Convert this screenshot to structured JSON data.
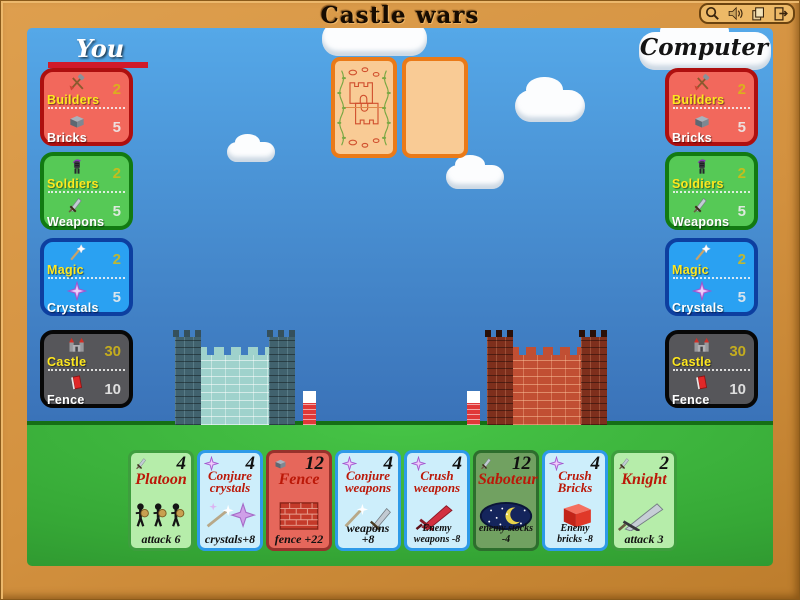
{
  "title": "Castle wars",
  "toolbar": {
    "icons": [
      "magnifier-icon",
      "sound-icon",
      "cards-icon",
      "exit-icon"
    ]
  },
  "players": {
    "you": "You",
    "computer": "Computer"
  },
  "stats": {
    "left": [
      {
        "rows": [
          {
            "icon": "tools-icon",
            "label": "Builders",
            "value": "2"
          },
          {
            "icon": "brick-icon",
            "label": "Bricks",
            "value": "5"
          }
        ]
      },
      {
        "rows": [
          {
            "icon": "soldier-icon",
            "label": "Soldiers",
            "value": "2"
          },
          {
            "icon": "sword-icon",
            "label": "Weapons",
            "value": "5"
          }
        ]
      },
      {
        "rows": [
          {
            "icon": "wand-icon",
            "label": "Magic",
            "value": "2"
          },
          {
            "icon": "crystal-icon",
            "label": "Crystals",
            "value": "5"
          }
        ]
      },
      {
        "rows": [
          {
            "icon": "castle-icon",
            "label": "Castle",
            "value": "30"
          },
          {
            "icon": "fence-icon",
            "label": "Fence",
            "value": "10"
          }
        ]
      }
    ],
    "right": [
      {
        "rows": [
          {
            "icon": "tools-icon",
            "label": "Builders",
            "value": "2"
          },
          {
            "icon": "brick-icon",
            "label": "Bricks",
            "value": "5"
          }
        ]
      },
      {
        "rows": [
          {
            "icon": "soldier-icon",
            "label": "Soldiers",
            "value": "2"
          },
          {
            "icon": "sword-icon",
            "label": "Weapons",
            "value": "5"
          }
        ]
      },
      {
        "rows": [
          {
            "icon": "wand-icon",
            "label": "Magic",
            "value": "2"
          },
          {
            "icon": "crystal-icon",
            "label": "Crystals",
            "value": "5"
          }
        ]
      },
      {
        "rows": [
          {
            "icon": "castle-icon",
            "label": "Castle",
            "value": "30"
          },
          {
            "icon": "fence-icon",
            "label": "Fence",
            "value": "10"
          }
        ]
      }
    ]
  },
  "board": {
    "deck_icon": "card-back",
    "played_pile_icon": "empty-card",
    "left_castle": "blue-castle",
    "right_castle": "red-castle"
  },
  "hand": {
    "cards": [
      {
        "title": "Platoon",
        "cost": "4",
        "effect": "attack 6",
        "icon": "sword-icon",
        "art": "platoon-art"
      },
      {
        "title": "Conjure crystals",
        "cost": "4",
        "effect": "crystals+8",
        "icon": "crystal-icon",
        "art": "wand-crystal-art"
      },
      {
        "title": "Fence",
        "cost": "12",
        "effect": "fence +22",
        "icon": "brick-icon",
        "art": "brick-wall-art"
      },
      {
        "title": "Conjure weapons",
        "cost": "4",
        "effect": "weapons +8",
        "icon": "crystal-icon",
        "art": "wand-sword-art"
      },
      {
        "title": "Crush weapons",
        "cost": "4",
        "effect": "Enemy weapons -8",
        "icon": "crystal-icon",
        "art": "red-sword-art"
      },
      {
        "title": "Saboteur",
        "cost": "12",
        "effect": "enemy stocks -4",
        "icon": "sword-icon",
        "art": "night-art"
      },
      {
        "title": "Crush Bricks",
        "cost": "4",
        "effect": "Enemy bricks -8",
        "icon": "crystal-icon",
        "art": "red-brick-art"
      },
      {
        "title": "Knight",
        "cost": "2",
        "effect": "attack 3",
        "icon": "sword-icon",
        "art": "big-sword-art"
      }
    ]
  },
  "colors": {
    "frame": "#d3913f",
    "sky_top": "#55a8e8",
    "sky_bottom": "#3a72b8",
    "grass": "#3fbf3f",
    "panel_red": "#f2685c",
    "panel_green": "#56c956",
    "panel_blue": "#2aa1f2",
    "panel_black": "#56565a",
    "card_green": "#b6edaa",
    "card_blue": "#cdeefb",
    "card_red": "#e6675b",
    "card_dark": "#71a161",
    "card_back_border": "#ea7a18",
    "card_back_fill": "#f9cb95",
    "underline_red": "#d01a2a",
    "label_yellow": "#ffe81e",
    "title_red": "#bb1808"
  }
}
